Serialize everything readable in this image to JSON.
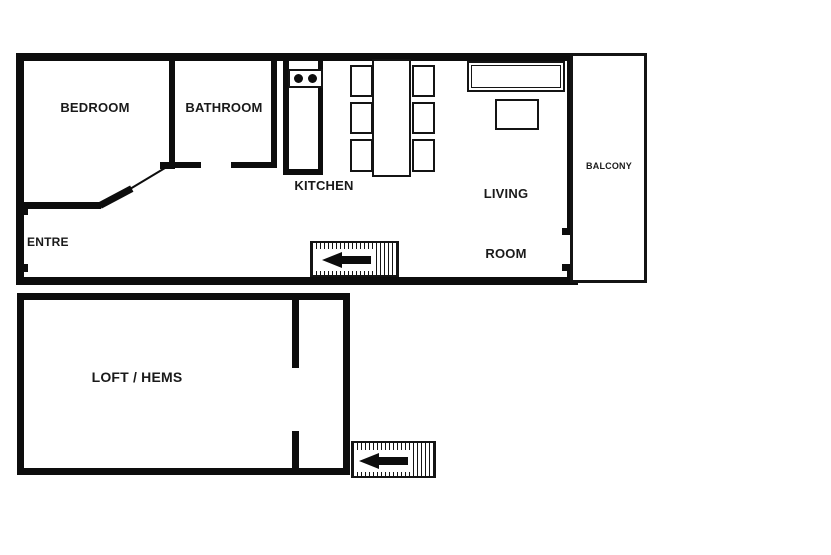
{
  "plan": {
    "upper_floor": {
      "bedroom_label": "BEDROOM",
      "bathroom_label": "BATHROOM",
      "kitchen_label": "KITCHEN",
      "living_room_label_line1": "LIVING",
      "living_room_label_line2": "ROOM",
      "balcony_label": "BALCONY",
      "entry_label": "ENTRE"
    },
    "lower_floor": {
      "loft_label": "LOFT / HEMS"
    },
    "furniture": {
      "stove_burners": 2,
      "dining_chairs": 6,
      "items": [
        "stove",
        "dining-table",
        "chair",
        "sofa",
        "coffee-table"
      ]
    },
    "stairs": {
      "upper_direction": "left",
      "lower_direction": "left"
    },
    "colors": {
      "wall": "#0d0d0d",
      "background": "#ffffff"
    }
  }
}
